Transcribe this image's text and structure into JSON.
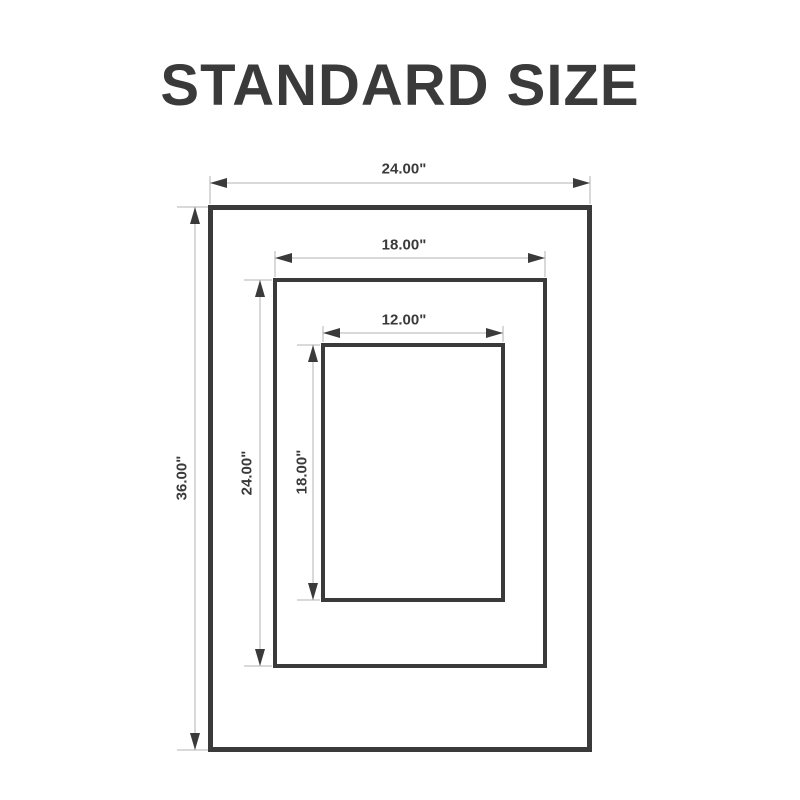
{
  "title": "STANDARD SIZE",
  "colors": {
    "stroke_dark": "#3a3a3a",
    "dim_line": "#b3b3b3",
    "background": "#ffffff"
  },
  "diagram": {
    "type": "nested-frame-dimension-diagram",
    "unit": "inches",
    "frames": [
      {
        "id": "outer",
        "width_in": 24,
        "height_in": 36,
        "width_label": "24.00\"",
        "height_label": "36.00\""
      },
      {
        "id": "middle",
        "width_in": 18,
        "height_in": 24,
        "width_label": "18.00\"",
        "height_label": "24.00\""
      },
      {
        "id": "inner",
        "width_in": 12,
        "height_in": 18,
        "width_label": "12.00\"",
        "height_label": "18.00\""
      }
    ]
  }
}
